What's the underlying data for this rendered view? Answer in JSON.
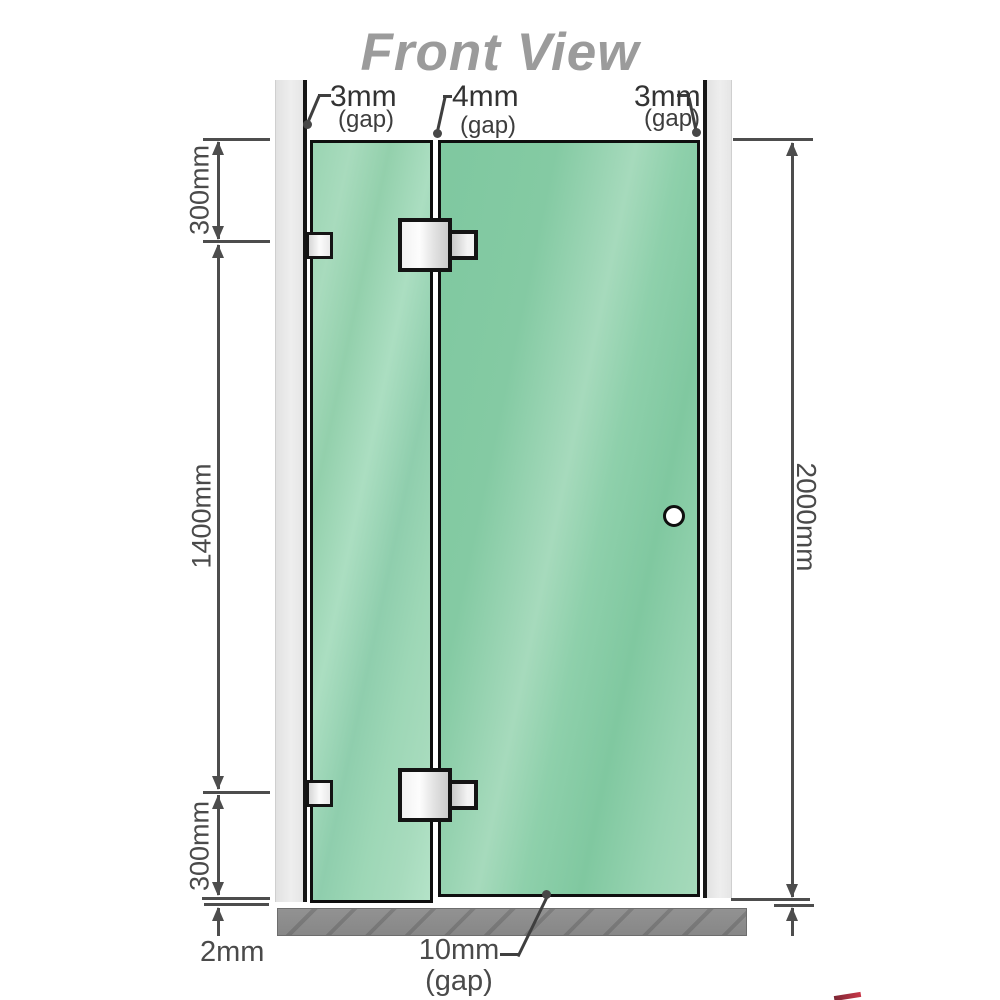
{
  "title": "Front View",
  "dimension_labels": {
    "top_gaps": [
      {
        "value": "3mm",
        "qualifier": "(gap)",
        "position": "left"
      },
      {
        "value": "4mm",
        "qualifier": "(gap)",
        "position": "middle"
      },
      {
        "value": "3mm",
        "qualifier": "(gap)",
        "position": "right"
      }
    ],
    "left_segments": {
      "top": "300mm",
      "middle": "1400mm",
      "bottom": "300mm"
    },
    "floor_offset": "2mm",
    "total_height": "2000mm",
    "bottom_gap": {
      "value": "10mm",
      "qualifier": "(gap)"
    }
  },
  "colors": {
    "glass_base": "#8BCDA9",
    "glass_highlight": "#ABDEC1",
    "wall_channel": "#E9E9E9",
    "floor": "#8D8D8D",
    "outline": "#141414",
    "dimension_lines": "#4D4D4D",
    "title_text": "#9B9B9B",
    "logo_red": "#C42134"
  }
}
